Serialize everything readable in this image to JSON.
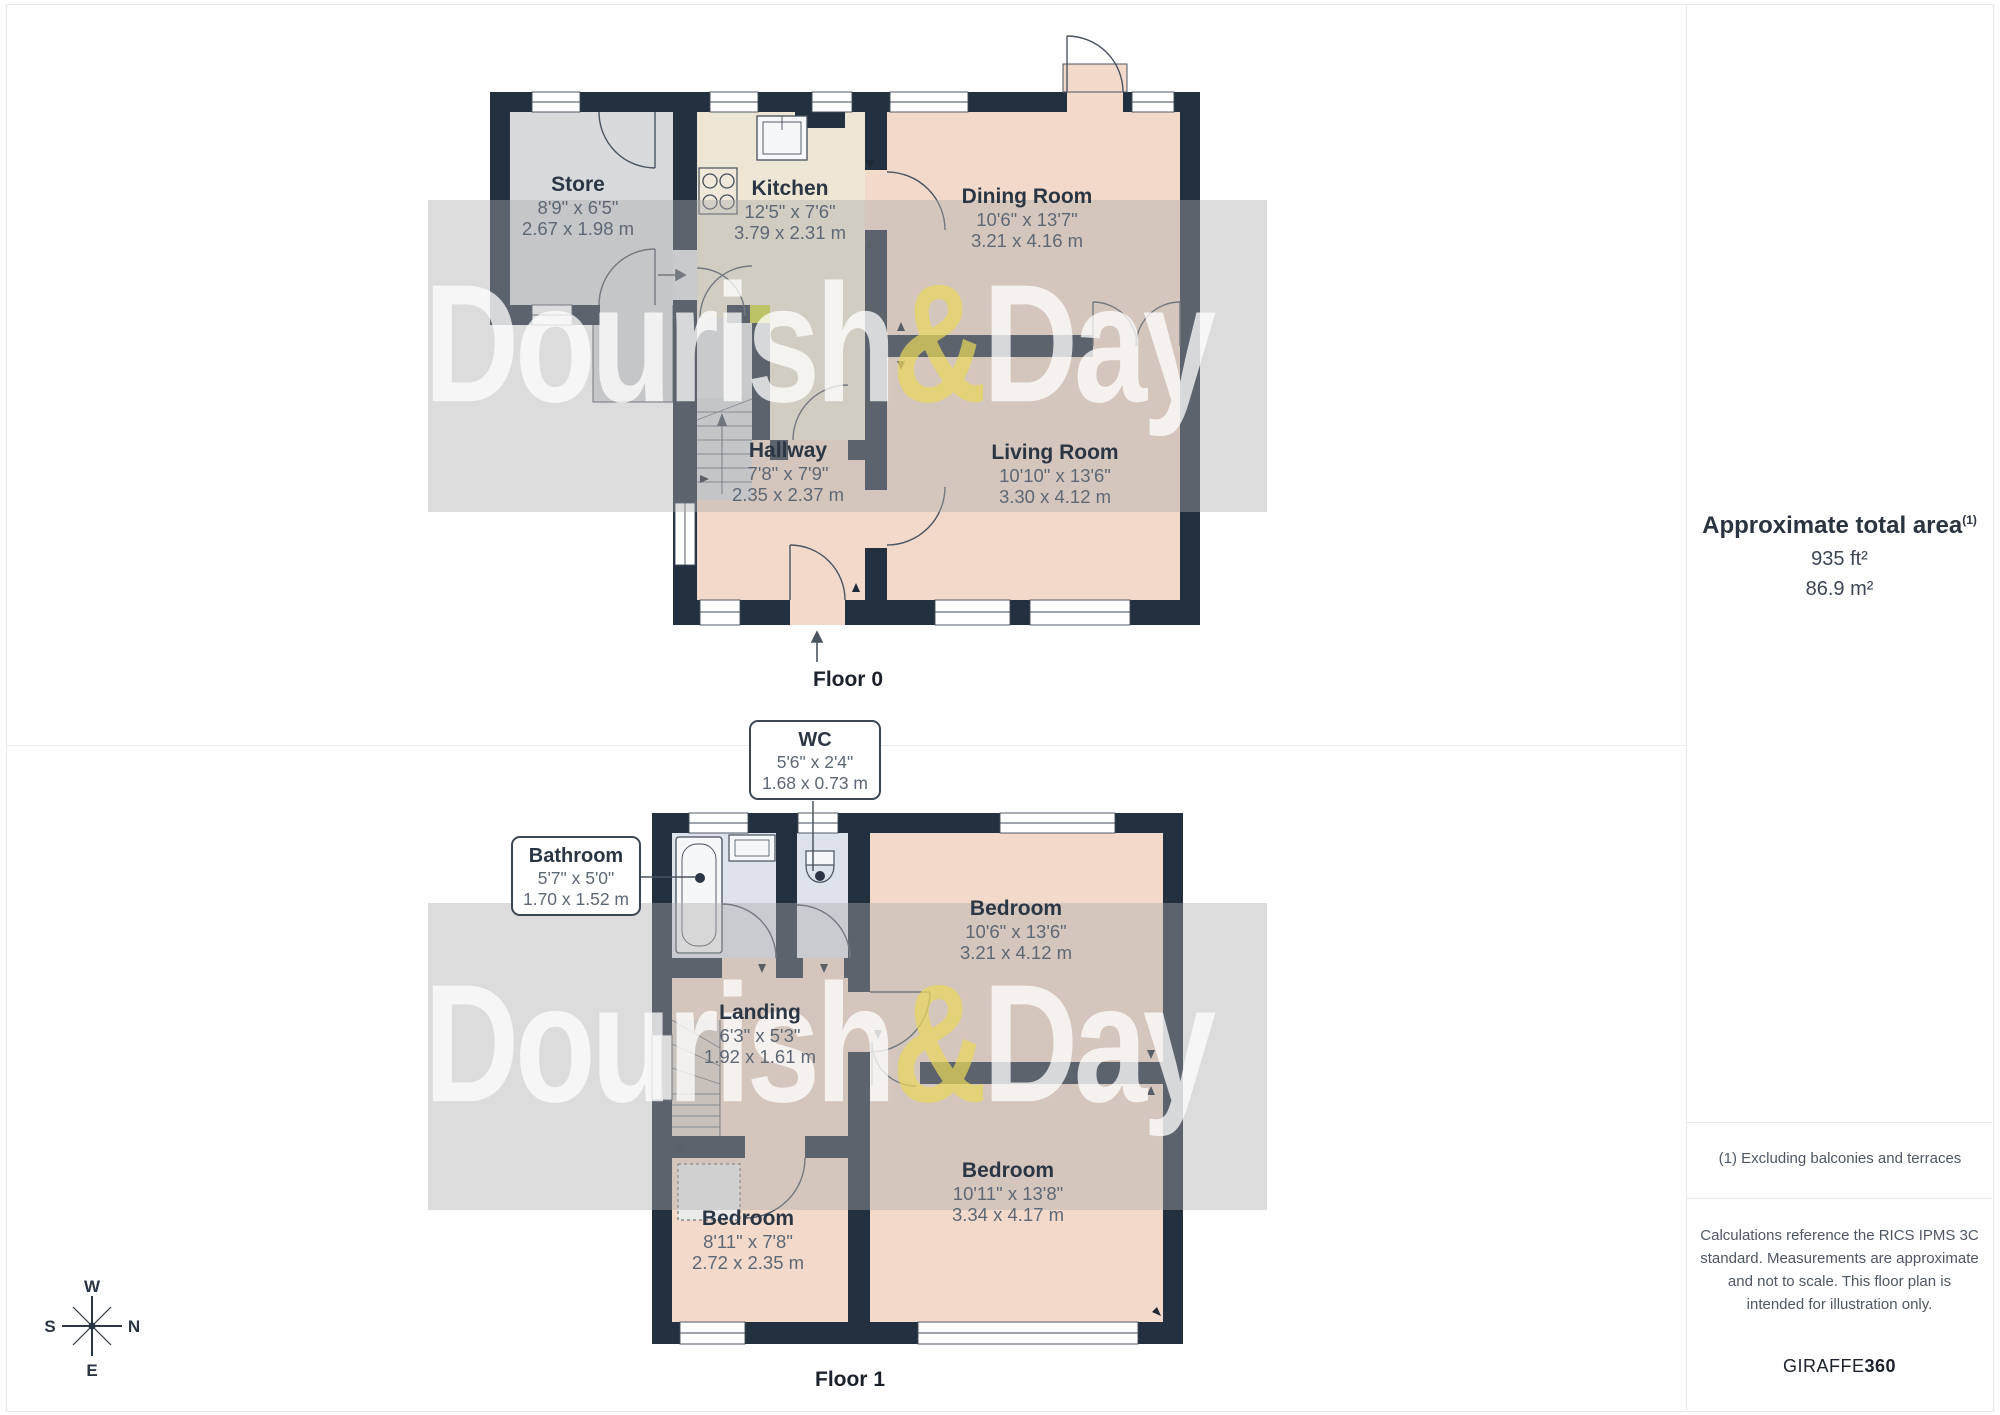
{
  "watermark": {
    "part1": "Dourish",
    "amp": "&",
    "part2": "Day"
  },
  "compass": {
    "top": "W",
    "right": "N",
    "bottom": "E",
    "left": "S"
  },
  "floor0": {
    "label": "Floor 0",
    "rooms": [
      {
        "name": "Store",
        "imperial": "8'9\" x 6'5\"",
        "metric": "2.67 x 1.98 m"
      },
      {
        "name": "Kitchen",
        "imperial": "12'5\" x 7'6\"",
        "metric": "3.79 x 2.31 m"
      },
      {
        "name": "Dining Room",
        "imperial": "10'6\" x 13'7\"",
        "metric": "3.21 x 4.16 m"
      },
      {
        "name": "Hallway",
        "imperial": "7'8\" x 7'9\"",
        "metric": "2.35 x 2.37 m"
      },
      {
        "name": "Living Room",
        "imperial": "10'10\" x 13'6\"",
        "metric": "3.30 x 4.12 m"
      }
    ]
  },
  "floor1": {
    "label": "Floor 1",
    "callouts": [
      {
        "name": "WC",
        "imperial": "5'6\" x 2'4\"",
        "metric": "1.68 x 0.73 m"
      },
      {
        "name": "Bathroom",
        "imperial": "5'7\" x 5'0\"",
        "metric": "1.70 x 1.52 m"
      }
    ],
    "rooms": [
      {
        "name": "Bedroom",
        "imperial": "10'6\" x 13'6\"",
        "metric": "3.21 x 4.12 m"
      },
      {
        "name": "Landing",
        "imperial": "6'3\" x 5'3\"",
        "metric": "1.92 x 1.61 m"
      },
      {
        "name": "Bedroom",
        "imperial": "8'11\" x 7'8\"",
        "metric": "2.72 x 2.35 m"
      },
      {
        "name": "Bedroom",
        "imperial": "10'11\" x 13'8\"",
        "metric": "3.34 x 4.17 m"
      }
    ]
  },
  "panel": {
    "title": "Approximate total area",
    "title_superscript": "(1)",
    "area_imperial": "935 ft²",
    "area_metric": "86.9 m²",
    "note": "(1) Excluding balconies and terraces",
    "disclaimer": "Calculations reference the RICS IPMS 3C standard. Measurements are approximate and not to scale. This floor plan is intended for illustration only.",
    "brand_name": "GIRAFFE",
    "brand_number": "360"
  },
  "colors": {
    "wall": "#233040",
    "room_pink": "#f3d9ca",
    "room_cream": "#ede6d5",
    "room_gray": "#d8dadb",
    "room_bath": "#dee2eb",
    "stair_gray": "#d5d8d9",
    "door_highlight": "#c9d434",
    "watermark_amp": "#e9d75c"
  }
}
